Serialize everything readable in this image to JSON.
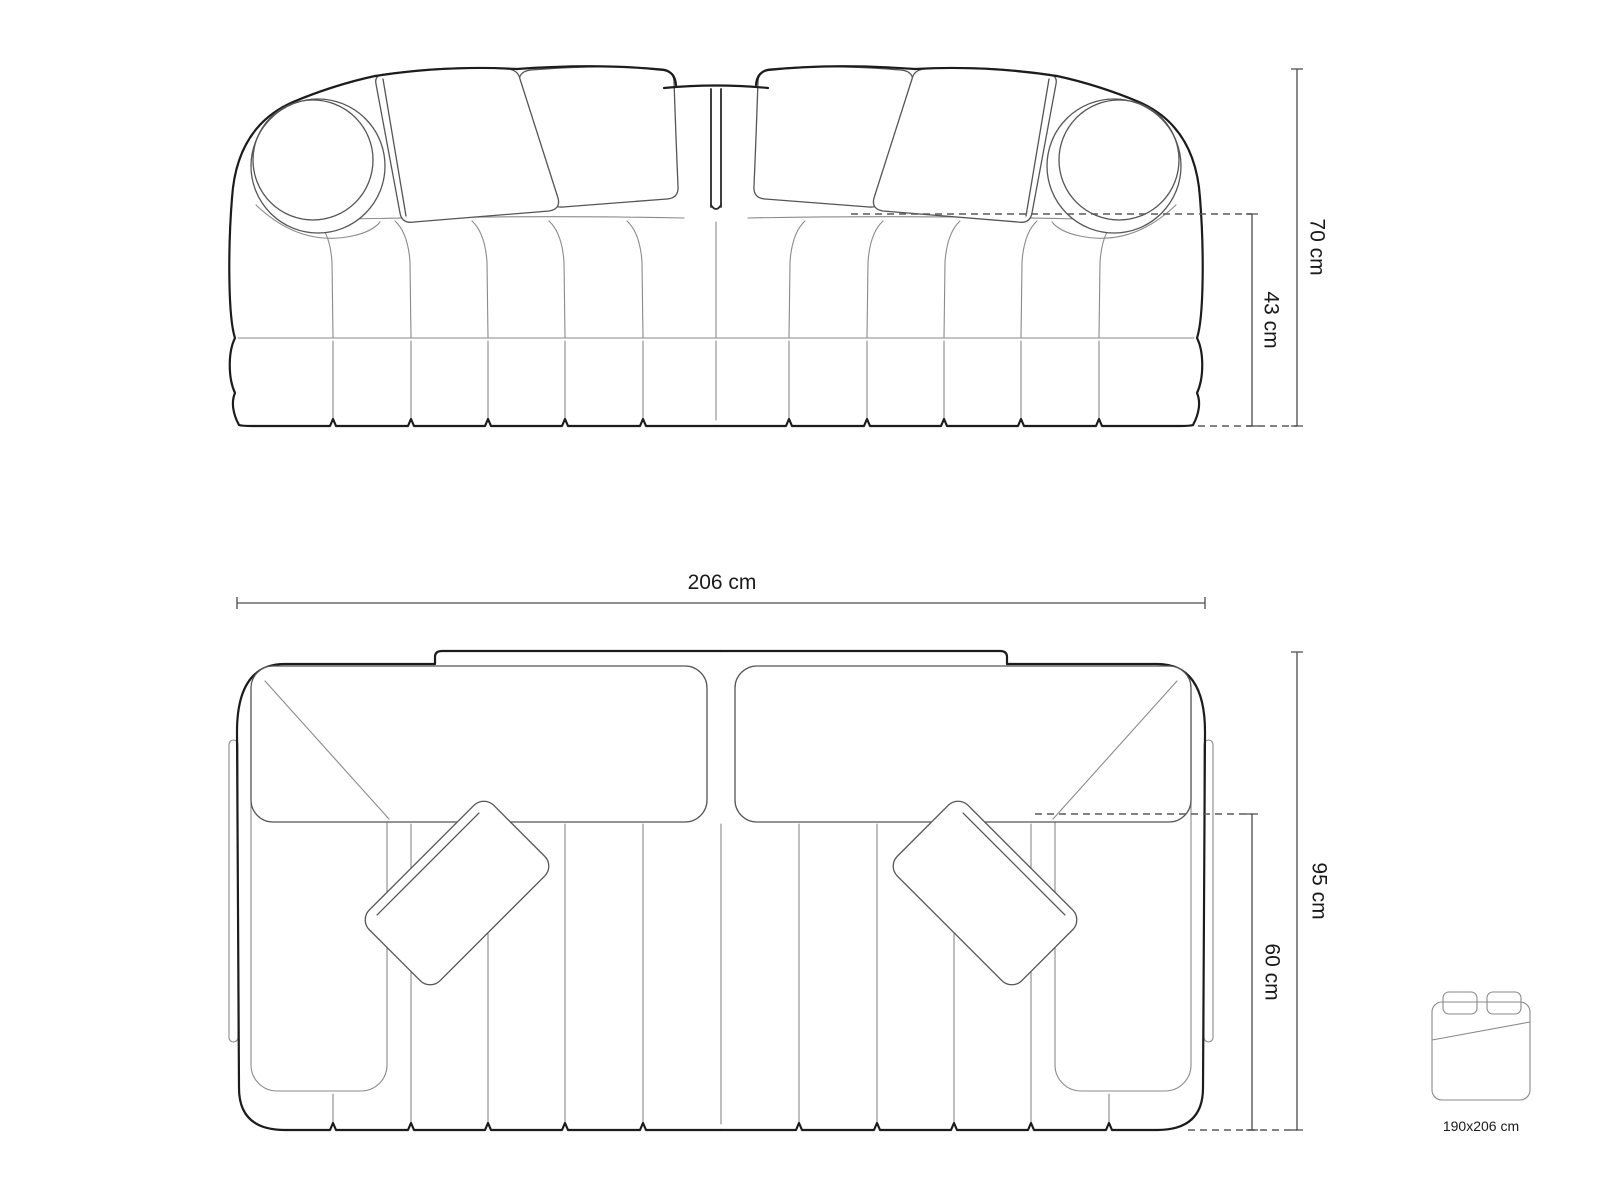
{
  "document": {
    "type": "sofa-dimension-diagram",
    "background": "#ffffff"
  },
  "colors": {
    "outline": "#1c1c1c",
    "thin_line": "#8a8a8a",
    "cushion_line": "#555555",
    "dimension_line": "#4c4c4c",
    "text": "#1a1a1a"
  },
  "views": {
    "front": {
      "name": "front elevation",
      "dimensions": {
        "overall_height": {
          "label": "70 cm"
        },
        "seat_height": {
          "label": "43 cm"
        }
      }
    },
    "top": {
      "name": "top plan",
      "dimensions": {
        "overall_width": {
          "label": "206 cm"
        },
        "overall_depth": {
          "label": "95 cm"
        },
        "seat_depth": {
          "label": "60 cm"
        }
      }
    }
  },
  "sleeping_area": {
    "label": "190x206 cm"
  }
}
